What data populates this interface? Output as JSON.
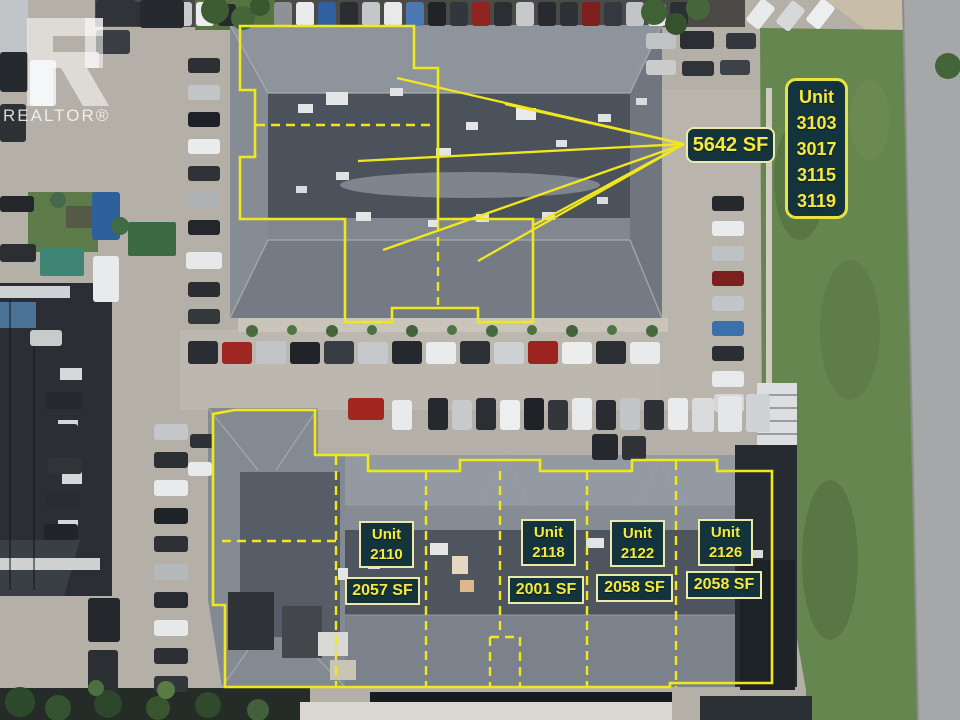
{
  "watermark": {
    "brand_text": "REALTOR®",
    "logo_glyph": "R"
  },
  "colors": {
    "annotation_yellow": "#f0e71c",
    "label_bg": "#13343c",
    "label_border": "#ece9ac",
    "label_text": "#f6e93c"
  },
  "top_building": {
    "sf_label": "5642 SF",
    "units_panel": {
      "lines": [
        "Unit",
        "3103",
        "3017",
        "3115",
        "3119"
      ]
    }
  },
  "bottom_building": {
    "units": [
      {
        "line1": "Unit",
        "line2": "2110",
        "sf": "2057 SF"
      },
      {
        "line1": "Unit",
        "line2": "2118",
        "sf": "2001 SF"
      },
      {
        "line1": "Unit",
        "line2": "2122",
        "sf": "2058 SF"
      },
      {
        "line1": "Unit",
        "line2": "2126",
        "sf": "2058 SF"
      }
    ]
  },
  "overlay": {
    "top_outline": "M240,26 L414,26 L414,68 L438,68 L438,219 L533,219 L533,322 L478,322 L478,308 L392,308 L392,322 L345,322 L345,219 L240,219 L240,157 L255,157 L255,90 L240,90 Z",
    "top_dashed": [
      "M256,125 L436,125",
      "M438,222 L438,305"
    ],
    "callout_origin": [
      684,
      144
    ],
    "callout_targets": [
      [
        397,
        78
      ],
      [
        505,
        104
      ],
      [
        358,
        161
      ],
      [
        383,
        250
      ],
      [
        478,
        261
      ],
      [
        532,
        226
      ]
    ],
    "bottom_outline": "M235,410 L315,410 L315,455 L368,455 L368,471 L460,471 L460,460 L540,460 L540,471 L632,471 L632,460 L717,460 L717,471 L772,471 L772,683 L670,683 L670,687 L225,687 L225,605 L213,605 L213,414 Z",
    "bottom_dashed": [
      "M336,456 L336,687",
      "M426,471 L426,687",
      "M500,471 L500,635",
      "M587,471 L587,687",
      "M676,461 L676,687",
      "M490,637 L490,687",
      "M490,637 L520,637",
      "M520,637 L520,687",
      "M222,541 L336,541"
    ]
  },
  "scenery": {
    "cars": [
      [
        130,
        2,
        18,
        24,
        "#2e3237"
      ],
      [
        152,
        2,
        18,
        24,
        "#3c66a2"
      ],
      [
        174,
        2,
        18,
        24,
        "#c8cbce"
      ],
      [
        196,
        2,
        18,
        24,
        "#ebedee"
      ],
      [
        218,
        4,
        18,
        22,
        "#26292e"
      ],
      [
        274,
        2,
        18,
        24,
        "#8e9296"
      ],
      [
        296,
        2,
        18,
        24,
        "#e9ebec"
      ],
      [
        318,
        2,
        18,
        24,
        "#30609f"
      ],
      [
        340,
        2,
        18,
        24,
        "#2a2e33"
      ],
      [
        362,
        2,
        18,
        24,
        "#c4c7ca"
      ],
      [
        384,
        2,
        18,
        24,
        "#e7e9ea"
      ],
      [
        406,
        2,
        18,
        24,
        "#4a79b4"
      ],
      [
        428,
        2,
        18,
        24,
        "#202428"
      ],
      [
        450,
        2,
        18,
        24,
        "#32373d"
      ],
      [
        472,
        2,
        18,
        24,
        "#8f2421"
      ],
      [
        494,
        2,
        18,
        24,
        "#2b2f34"
      ],
      [
        516,
        2,
        18,
        24,
        "#c6c9cc"
      ],
      [
        538,
        2,
        18,
        24,
        "#272a2f"
      ],
      [
        560,
        2,
        18,
        24,
        "#2e3237"
      ],
      [
        582,
        2,
        18,
        24,
        "#7d1f1e"
      ],
      [
        604,
        2,
        18,
        24,
        "#34393f"
      ],
      [
        626,
        2,
        18,
        24,
        "#c2c5c8"
      ],
      [
        648,
        4,
        18,
        22,
        "#e8eaeb"
      ],
      [
        670,
        2,
        18,
        24,
        "#2c3035"
      ],
      [
        752,
        0,
        17,
        28,
        "#e8eaec",
        38
      ],
      [
        782,
        2,
        17,
        28,
        "#d6d8da",
        38
      ],
      [
        812,
        0,
        17,
        28,
        "#eceeef",
        38
      ],
      [
        646,
        33,
        30,
        16,
        "#c0c3c5"
      ],
      [
        680,
        31,
        34,
        18,
        "#2b2f34"
      ],
      [
        726,
        33,
        30,
        16,
        "#34383e"
      ],
      [
        646,
        60,
        30,
        15,
        "#c9cbcd"
      ],
      [
        682,
        61,
        32,
        15,
        "#303439"
      ],
      [
        720,
        60,
        30,
        15,
        "#3d4248"
      ],
      [
        712,
        196,
        32,
        15,
        "#26292d"
      ],
      [
        712,
        221,
        32,
        15,
        "#e9ebec"
      ],
      [
        712,
        246,
        32,
        15,
        "#bfc2c4"
      ],
      [
        712,
        271,
        32,
        15,
        "#7a201f"
      ],
      [
        712,
        296,
        32,
        15,
        "#c3c6c8"
      ],
      [
        712,
        321,
        32,
        15,
        "#3b70ad"
      ],
      [
        712,
        346,
        32,
        15,
        "#2a2e33"
      ],
      [
        712,
        371,
        32,
        16,
        "#e7e9ea"
      ],
      [
        714,
        394,
        30,
        18,
        "#d4d6d8"
      ],
      [
        188,
        58,
        32,
        15,
        "#2c3035"
      ],
      [
        188,
        85,
        32,
        15,
        "#c3c6c9"
      ],
      [
        188,
        112,
        32,
        15,
        "#1e2226"
      ],
      [
        188,
        139,
        32,
        15,
        "#e9ebec"
      ],
      [
        188,
        166,
        32,
        15,
        "#2f3338"
      ],
      [
        188,
        193,
        32,
        15,
        "#aeb1b4"
      ],
      [
        188,
        220,
        32,
        15,
        "#23272b"
      ],
      [
        186,
        252,
        36,
        17,
        "#e6e8e9"
      ],
      [
        188,
        282,
        32,
        15,
        "#2a2e32"
      ],
      [
        188,
        309,
        32,
        15,
        "#33383d"
      ],
      [
        0,
        52,
        28,
        40,
        "#26292d"
      ],
      [
        30,
        60,
        26,
        46,
        "#e9ebed"
      ],
      [
        0,
        104,
        26,
        38,
        "#2e3136"
      ],
      [
        0,
        196,
        34,
        16,
        "#23262a"
      ],
      [
        0,
        244,
        36,
        18,
        "#2b2e33"
      ],
      [
        92,
        192,
        28,
        48,
        "#2e609c"
      ],
      [
        93,
        256,
        26,
        46,
        "#e8eaec"
      ],
      [
        30,
        330,
        32,
        16,
        "#c8cacc"
      ],
      [
        46,
        392,
        36,
        17,
        "#25282c"
      ],
      [
        44,
        424,
        34,
        16,
        "#2b2f34"
      ],
      [
        48,
        458,
        34,
        16,
        "#303439"
      ],
      [
        46,
        492,
        34,
        16,
        "#282b30"
      ],
      [
        44,
        524,
        34,
        16,
        "#212428"
      ],
      [
        188,
        341,
        30,
        23,
        "#2a2d32"
      ],
      [
        222,
        342,
        30,
        22,
        "#a02622"
      ],
      [
        256,
        341,
        30,
        23,
        "#c2c5c7"
      ],
      [
        290,
        342,
        30,
        22,
        "#202327"
      ],
      [
        324,
        341,
        30,
        23,
        "#383d43"
      ],
      [
        358,
        342,
        30,
        22,
        "#c6c9cb"
      ],
      [
        392,
        341,
        30,
        23,
        "#26292e"
      ],
      [
        426,
        342,
        30,
        22,
        "#e9ebed"
      ],
      [
        460,
        341,
        30,
        23,
        "#2d3136"
      ],
      [
        494,
        342,
        30,
        22,
        "#ced1d3"
      ],
      [
        528,
        341,
        30,
        23,
        "#9c2420"
      ],
      [
        562,
        342,
        30,
        22,
        "#eceded"
      ],
      [
        596,
        341,
        30,
        23,
        "#2b2f34"
      ],
      [
        630,
        342,
        30,
        22,
        "#e8eaeb"
      ],
      [
        348,
        398,
        36,
        22,
        "#a4271f"
      ],
      [
        392,
        400,
        20,
        30,
        "#e8eaec"
      ],
      [
        428,
        398,
        20,
        32,
        "#25282d"
      ],
      [
        452,
        400,
        20,
        30,
        "#c7cacc"
      ],
      [
        476,
        398,
        20,
        32,
        "#2b2f34"
      ],
      [
        500,
        400,
        20,
        30,
        "#eceeef"
      ],
      [
        524,
        398,
        20,
        32,
        "#1f2327"
      ],
      [
        548,
        400,
        20,
        30,
        "#33373c"
      ],
      [
        572,
        398,
        20,
        32,
        "#e7e9eb"
      ],
      [
        596,
        400,
        20,
        30,
        "#282c31"
      ],
      [
        620,
        398,
        20,
        32,
        "#c3c6c8"
      ],
      [
        644,
        400,
        20,
        30,
        "#2e3237"
      ],
      [
        668,
        398,
        20,
        32,
        "#e9ebec"
      ],
      [
        692,
        398,
        22,
        34,
        "#d9dbdd"
      ],
      [
        718,
        396,
        24,
        36,
        "#e4e6e7"
      ],
      [
        746,
        394,
        24,
        38,
        "#d0d3d5"
      ],
      [
        592,
        434,
        26,
        26,
        "#26292d"
      ],
      [
        622,
        436,
        24,
        24,
        "#2f3338"
      ],
      [
        154,
        424,
        34,
        16,
        "#c4c7c9"
      ],
      [
        154,
        452,
        34,
        16,
        "#2b2e33"
      ],
      [
        154,
        480,
        34,
        16,
        "#e8eaec"
      ],
      [
        154,
        508,
        34,
        16,
        "#1f2226"
      ],
      [
        154,
        536,
        34,
        16,
        "#2e3136"
      ],
      [
        154,
        564,
        34,
        16,
        "#b6b9bb"
      ],
      [
        154,
        592,
        34,
        16,
        "#282b2f"
      ],
      [
        154,
        620,
        34,
        16,
        "#e6e8ea"
      ],
      [
        154,
        648,
        34,
        16,
        "#2c2f34"
      ],
      [
        154,
        676,
        34,
        16,
        "#33363b"
      ],
      [
        190,
        434,
        24,
        14,
        "#2e3237"
      ],
      [
        188,
        462,
        24,
        14,
        "#e7e9ea"
      ],
      [
        88,
        598,
        32,
        44,
        "#23262b"
      ],
      [
        88,
        650,
        30,
        42,
        "#2b2e33"
      ],
      [
        96,
        0,
        40,
        26,
        "#303338"
      ],
      [
        140,
        0,
        44,
        28,
        "#26292e"
      ],
      [
        96,
        30,
        34,
        24,
        "#3a3e44"
      ]
    ],
    "roof_units": [
      [
        326,
        92,
        22,
        13,
        "#e3e5e7"
      ],
      [
        298,
        104,
        15,
        9,
        "#e3e5e7"
      ],
      [
        390,
        88,
        13,
        8,
        "#dfe1e3"
      ],
      [
        516,
        108,
        20,
        12,
        "#e8eaeb"
      ],
      [
        598,
        114,
        13,
        8,
        "#dfe1e3"
      ],
      [
        636,
        98,
        11,
        7,
        "#d9dbdd"
      ],
      [
        436,
        148,
        15,
        9,
        "#e3e5e7"
      ],
      [
        336,
        172,
        13,
        8,
        "#dfe1e3"
      ],
      [
        296,
        186,
        11,
        7,
        "#d9dbdd"
      ],
      [
        356,
        212,
        15,
        9,
        "#e3e5e7"
      ],
      [
        476,
        214,
        13,
        8,
        "#dfe1e3"
      ],
      [
        428,
        220,
        11,
        7,
        "#e3e5e7"
      ],
      [
        542,
        212,
        13,
        8,
        "#dfe1e3"
      ],
      [
        597,
        197,
        11,
        7,
        "#d9dbdd"
      ],
      [
        466,
        122,
        12,
        8,
        "#e3e5e7"
      ],
      [
        556,
        140,
        11,
        7,
        "#dfe1e3"
      ],
      [
        430,
        543,
        18,
        12,
        "#e3e5e7"
      ],
      [
        452,
        556,
        16,
        18,
        "#e7d7c2"
      ],
      [
        460,
        580,
        14,
        12,
        "#dcb98c"
      ],
      [
        586,
        538,
        18,
        10,
        "#e2e4e6"
      ],
      [
        618,
        552,
        13,
        9,
        "#dfe1e3"
      ],
      [
        698,
        546,
        15,
        10,
        "#e2e4e6"
      ],
      [
        752,
        550,
        11,
        8,
        "#d9dbdd"
      ],
      [
        368,
        560,
        12,
        9,
        "#dfe1e3"
      ],
      [
        338,
        568,
        10,
        12,
        "#e3e5e7"
      ]
    ],
    "trees": [
      [
        215,
        10,
        14,
        "#3d5c33"
      ],
      [
        243,
        18,
        12,
        "#466538"
      ],
      [
        260,
        6,
        10,
        "#3a5830"
      ],
      [
        654,
        12,
        13,
        "#406036"
      ],
      [
        676,
        24,
        11,
        "#35522c"
      ],
      [
        698,
        8,
        12,
        "#47663a"
      ],
      [
        948,
        66,
        13,
        "#44653a"
      ],
      [
        20,
        702,
        15,
        "#2e4a2c"
      ],
      [
        58,
        708,
        13,
        "#355231"
      ],
      [
        108,
        704,
        14,
        "#2b462a"
      ],
      [
        158,
        708,
        12,
        "#38552f"
      ],
      [
        208,
        705,
        13,
        "#2f4b2b"
      ],
      [
        258,
        710,
        11,
        "#41603b"
      ],
      [
        166,
        690,
        9,
        "#5a7a46"
      ],
      [
        96,
        688,
        8,
        "#4e7040"
      ],
      [
        120,
        226,
        9,
        "#3f6b45"
      ],
      [
        58,
        200,
        8,
        "#46694a"
      ]
    ],
    "bushes": [
      [
        252,
        331,
        6,
        "#4a6b3e"
      ],
      [
        292,
        330,
        5,
        "#527342"
      ],
      [
        332,
        331,
        6,
        "#466639"
      ],
      [
        372,
        330,
        5,
        "#4f7040"
      ],
      [
        412,
        331,
        6,
        "#44643a"
      ],
      [
        452,
        330,
        5,
        "#527343"
      ],
      [
        492,
        331,
        6,
        "#476a3c"
      ],
      [
        532,
        330,
        5,
        "#4f7040"
      ],
      [
        572,
        331,
        6,
        "#44643a"
      ],
      [
        612,
        330,
        5,
        "#527343"
      ],
      [
        652,
        331,
        6,
        "#476a3c"
      ]
    ]
  }
}
